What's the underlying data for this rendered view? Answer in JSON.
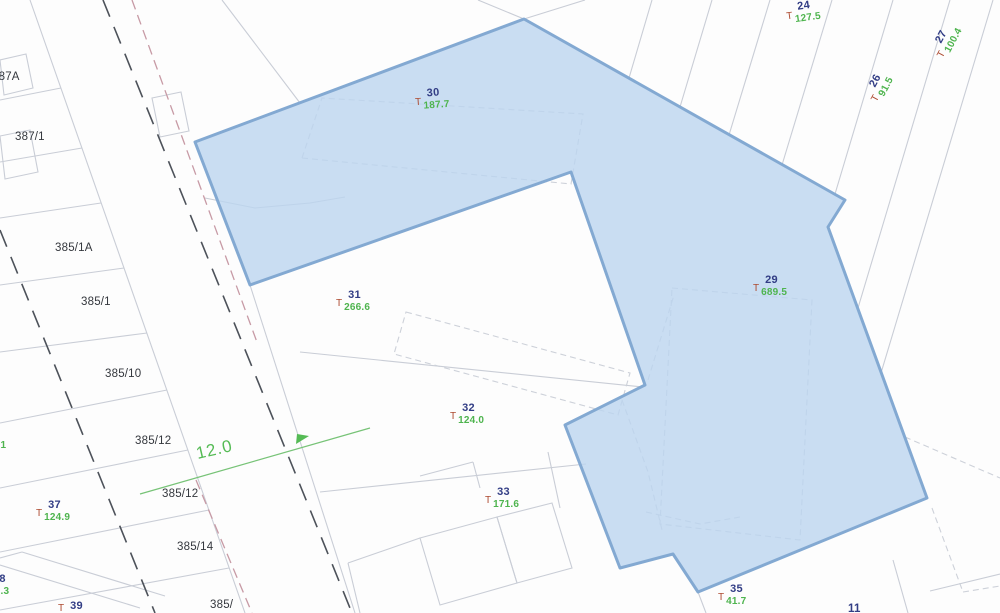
{
  "map": {
    "type": "cadastral-plan",
    "highlight": {
      "fill": "#bcd4ef",
      "stroke": "#83a9d2",
      "meaning": "highlighted-parcel-region"
    },
    "colors": {
      "parcel_line": "#c9cdd6",
      "dashed_building_line": "#cdd1d9",
      "road_centerline_dash": "#4d525a",
      "boundary_pink_dash": "#c79aa5",
      "dimension_green": "#55bb55",
      "parcel_number_navy": "#323d85",
      "area_value_green": "#4eb44e",
      "t_prefix_red": "#ad4a30",
      "parcel_text_black": "#34373d"
    },
    "parcel_labels": [
      {
        "text": "387A"
      },
      {
        "text": "387/1"
      },
      {
        "text": "385/1A"
      },
      {
        "text": "385/1"
      },
      {
        "text": "385/10"
      },
      {
        "text": "385/12"
      },
      {
        "text": "385/12"
      },
      {
        "text": "385/14"
      },
      {
        "text": "385/"
      },
      {
        "text": "11"
      }
    ],
    "t_labels": [
      {
        "prefix": "T",
        "number": "30",
        "area": "187.7"
      },
      {
        "prefix": "T",
        "number": "24",
        "area": "127.5"
      },
      {
        "prefix": "T",
        "number": "27",
        "area": "100.4"
      },
      {
        "prefix": "T",
        "number": "26",
        "area": "91.5"
      },
      {
        "prefix": "T",
        "number": "29",
        "area": "689.5"
      },
      {
        "prefix": "T",
        "number": "31",
        "area": "266.6"
      },
      {
        "prefix": "T",
        "number": "32",
        "area": "124.0"
      },
      {
        "prefix": "T",
        "number": "33",
        "area": "171.6"
      },
      {
        "prefix": "T",
        "number": "35",
        "area": "41.7"
      },
      {
        "prefix": "T",
        "number": "37",
        "area": "124.9"
      },
      {
        "prefix": "",
        "number": "38",
        "area": "53.3"
      },
      {
        "prefix": "T",
        "number": "39",
        "area": ""
      },
      {
        "prefix": "",
        "number": "3",
        "area": "90.1"
      }
    ],
    "dimension": {
      "value": "12.0"
    }
  }
}
